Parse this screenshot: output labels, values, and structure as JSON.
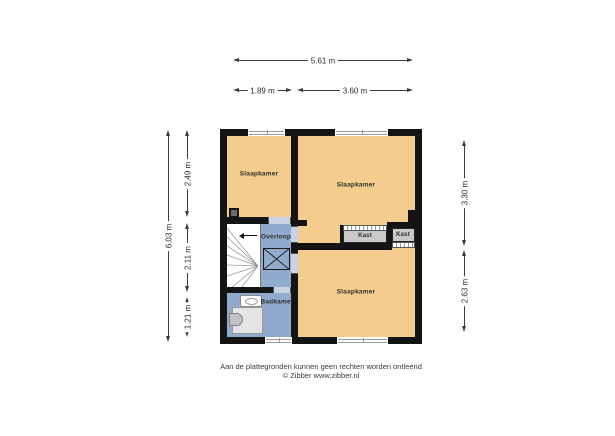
{
  "rooms": {
    "bedroom_top_left": {
      "label": "Slaapkamer"
    },
    "bedroom_top_right": {
      "label": "Slaapkamer"
    },
    "bedroom_bottom": {
      "label": "Slaapkamer"
    },
    "landing": {
      "label": "Overloop"
    },
    "bathroom": {
      "label": "Badkamer"
    },
    "closet_left": {
      "label": "Kast"
    },
    "closet_right": {
      "label": "Kast"
    }
  },
  "dimensions": {
    "top_total": "5.61 m",
    "top_seg_left": "1.89 m",
    "top_seg_right": "3.60 m",
    "left_total": "6.03 m",
    "left_seg_top": "2.49 m",
    "left_seg_mid": "2.11 m",
    "left_seg_bottom": "1.21 m",
    "right_seg_top": "3.30 m",
    "right_seg_bottom": "2.63 m"
  },
  "colors": {
    "room_fill": "#f4cc8e",
    "hall_fill": "#91aacd",
    "closet_fill": "#c9c9c9",
    "wall": "#141414",
    "dimension_text": "#2c2c2c"
  },
  "footer": {
    "disclaimer": "Aan de plattegronden kunnen geen rechten worden ontleend",
    "credit": "© Zibber www.zibber.nl"
  }
}
